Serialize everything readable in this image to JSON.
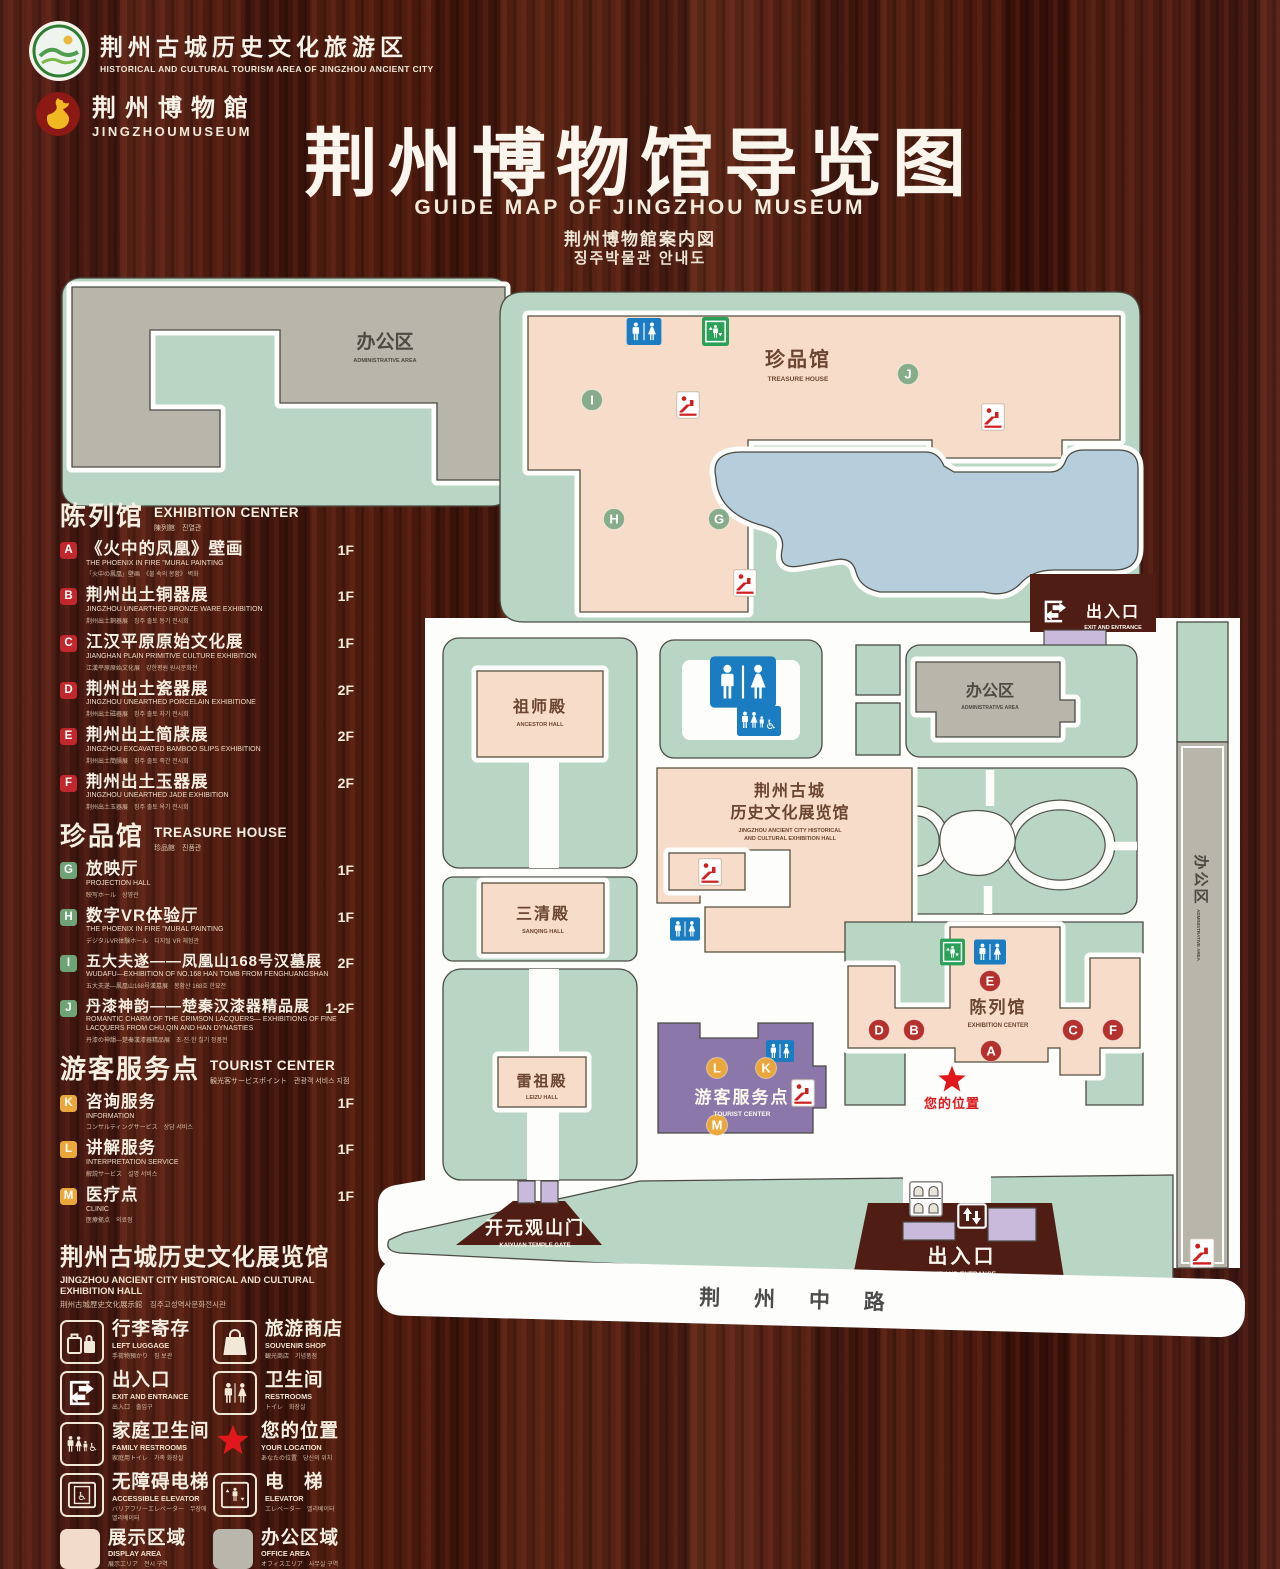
{
  "header": {
    "logo1": {
      "cn": "荆州古城历史文化旅游区",
      "en": "HISTORICAL AND CULTURAL TOURISM AREA OF JINGZHOU ANCIENT CITY"
    },
    "logo2": {
      "cn": "荆州博物館",
      "en": "JINGZHOUMUSEUM"
    },
    "title_cn": "荆州博物馆导览图",
    "title_en": "GUIDE MAP OF JINGZHOU MUSEUM",
    "title_jp": "荆州博物館案内図",
    "title_kr": "징주박물관 안내도"
  },
  "legend": {
    "exhibition": {
      "title_cn": "陈列馆",
      "title_en": "EXHIBITION CENTER",
      "title_sub": "陳列館　진열관",
      "items": [
        {
          "code": "A",
          "cn": "《火中的凤凰》壁画",
          "en": "THE PHOENIX IN FIRE \"MURAL PAINTING",
          "sub": "「火中の鳳凰」壁画　《불 속의 봉황》 벽화",
          "floor": "1F"
        },
        {
          "code": "B",
          "cn": "荆州出土铜器展",
          "en": "JINGZHOU UNEARTHED BRONZE WARE EXHIBITION",
          "sub": "荆州出土銅器展　징주 출토 동기 전시회",
          "floor": "1F"
        },
        {
          "code": "C",
          "cn": "江汉平原原始文化展",
          "en": "JIANGHAN PLAIN PRIMITIVE CULTURE EXHIBITION",
          "sub": "江漢平原原始文化展　강한평원 원시문화전",
          "floor": "1F"
        },
        {
          "code": "D",
          "cn": "荆州出土瓷器展",
          "en": "JINGZHOU UNEARTHED PORCELAIN EXHIBITIONE",
          "sub": "荆州出土磁器展　징주 출토 자기 전시회",
          "floor": "2F"
        },
        {
          "code": "E",
          "cn": "荆州出土简牍展",
          "en": "JINGZHOU EXCAVATED BAMBOO SLIPS EXHIBITION",
          "sub": "荆州出土簡牘展　징주 출토 죽간 전시회",
          "floor": "2F"
        },
        {
          "code": "F",
          "cn": "荆州出土玉器展",
          "en": "JINGZHOU UNEARTHED JADE EXHIBITION",
          "sub": "荆州出土玉器展　징주 출토 옥기 전시회",
          "floor": "2F"
        }
      ]
    },
    "treasure": {
      "title_cn": "珍品馆",
      "title_en": "TREASURE HOUSE",
      "title_sub": "珍品館　진품관",
      "items": [
        {
          "code": "G",
          "cn": "放映厅",
          "en": "PROJECTION HALL",
          "sub": "映写ホール　상영관",
          "floor": "1F"
        },
        {
          "code": "H",
          "cn": "数字VR体验厅",
          "en": "THE PHOENIX IN FIRE \"MURAL PAINTING",
          "sub": "デジタルVR体験ホール　디지털 VR 체험관",
          "floor": "1F"
        },
        {
          "code": "I",
          "cn": "五大夫遂——凤凰山168号汉墓展",
          "en": "WUDAFU—EXHIBITION OF NO.168 HAN TOMB FROM FENGHUANGSHAN",
          "sub": "五大夫遂—鳳凰山168号漢墓展　봉황산 168호 한묘전",
          "floor": "2F"
        },
        {
          "code": "J",
          "cn": "丹漆神韵——楚秦汉漆器精品展",
          "en": "ROMANTIC CHARM OF THE CRIMSON LACQUERS— EXHIBITIONS OF FINE LACQUERS FROM CHU,QIN AND HAN DYNASTIES",
          "sub": "丹漆の神韻—楚秦漢漆器精品展　초·진·한 칠기 정품전",
          "floor": "1-2F"
        }
      ]
    },
    "tourist": {
      "title_cn": "游客服务点",
      "title_en": "TOURIST CENTER",
      "title_sub": "観光客サービスポイント　관광객 서비스 지점",
      "items": [
        {
          "code": "K",
          "cn": "咨询服务",
          "en": "INFORMATION",
          "sub": "コンサルティングサービス　상담 서비스",
          "floor": "1F"
        },
        {
          "code": "L",
          "cn": "讲解服务",
          "en": "INTERPRETATION SERVICE",
          "sub": "解説サービス　설명 서비스",
          "floor": "1F"
        },
        {
          "code": "M",
          "cn": "医疗点",
          "en": "CLINIC",
          "sub": "医療拠点　의료점",
          "floor": "1F"
        }
      ]
    },
    "hall_note": {
      "cn": "荆州古城历史文化展览馆",
      "en": "JINGZHOU ANCIENT CITY HISTORICAL AND CULTURAL EXHIBITION HALL",
      "sub": "荆州古城歴史文化展示館　징주고성역사문화전시관"
    },
    "facilities": [
      {
        "icon": "left-luggage-icon",
        "cn": "行李寄存",
        "en": "LEFT LUGGAGE",
        "sub": "手荷物預かり　짐 보관"
      },
      {
        "icon": "souvenir-shop-icon",
        "cn": "旅游商店",
        "en": "SOUVENIR SHOP",
        "sub": "観光商店　기념품점"
      },
      {
        "icon": "exit-entrance-icon",
        "cn": "出入口",
        "en": "EXIT AND ENTRANCE",
        "sub": "出入口　출입구"
      },
      {
        "icon": "restrooms-icon",
        "cn": "卫生间",
        "en": "RESTROOMS",
        "sub": "トイレ　화장실"
      },
      {
        "icon": "family-restrooms-icon",
        "cn": "家庭卫生间",
        "en": "FAMILY RESTROOMS",
        "sub": "家庭用トイレ　가족 화장실"
      },
      {
        "icon": "your-location-icon",
        "cn": "您的位置",
        "en": "YOUR LOCATION",
        "sub": "あなたの位置　당신의 위치"
      },
      {
        "icon": "accessible-elevator-icon",
        "cn": "无障碍电梯",
        "en": "ACCESSIBLE ELEVATOR",
        "sub": "バリアフリーエレベーター　무장애 엘리베이터"
      },
      {
        "icon": "elevator-icon",
        "cn": "电　梯",
        "en": "ELEVATOR",
        "sub": "エレベーター　엘리베이터"
      },
      {
        "icon": "display-area-swatch",
        "cn": "展示区域",
        "en": "DISPLAY AREA",
        "sub": "展示エリア　전시 구역"
      },
      {
        "icon": "office-area-swatch",
        "cn": "办公区域",
        "en": "OFFICE AREA",
        "sub": "オフィスエリア　사무실 구역"
      }
    ]
  },
  "map": {
    "admin_top": {
      "cn": "办公区",
      "en": "ADMINISTRATIVE AREA"
    },
    "treasure": {
      "cn": "珍品馆",
      "en": "TREASURE HOUSE"
    },
    "ancestor": {
      "cn": "祖师殿",
      "en": "ANCESTOR HALL"
    },
    "sanqing": {
      "cn": "三清殿",
      "en": "SANQING HALL"
    },
    "leizu": {
      "cn": "雷祖殿",
      "en": "LEIZU HALL"
    },
    "exhibition_hall": {
      "cn1": "荆州古城",
      "cn2": "历史文化展览馆",
      "en1": "JINGZHOU ANCIENT CITY HISTORICAL",
      "en2": "AND CULTURAL EXHIBITION HALL"
    },
    "admin_right": {
      "cn": "办公区",
      "en": "ADMINISTRATIVE AREA"
    },
    "admin_strip": {
      "cn": "办公区",
      "en": "ADMINISTRATIVE AREA"
    },
    "exhibition_center": {
      "cn": "陈列馆",
      "en": "EXHIBITION CENTER"
    },
    "tourist_center": {
      "cn": "游客服务点",
      "en": "TOURIST CENTER"
    },
    "your_location": "您的位置",
    "exit_top": {
      "cn": "出入口",
      "en": "EXIT AND ENTRANCE"
    },
    "exit_bottom": {
      "cn": "出入口",
      "en": "EXIT AND ENTRANCE"
    },
    "kaiyuan": {
      "cn": "开元观山门",
      "en": "KAIYUAN TEMPLE GATE"
    },
    "road": "荆 州 中 路"
  },
  "colors": {
    "wood": "#4c1b12",
    "mint": "#b9d5c3",
    "building_pink": "#f7ddc9",
    "building_gray": "#b8b5aa",
    "lake_blue": "#b6cedc",
    "tourist_purple": "#8b77a9",
    "gate_purple": "#c9badb",
    "badge_red": "#c1272d",
    "badge_green": "#6fa375",
    "badge_orange": "#eaa73c",
    "sign_blue": "#1a7cc1",
    "sign_green": "#2aa157",
    "location_red": "#e0181b"
  }
}
